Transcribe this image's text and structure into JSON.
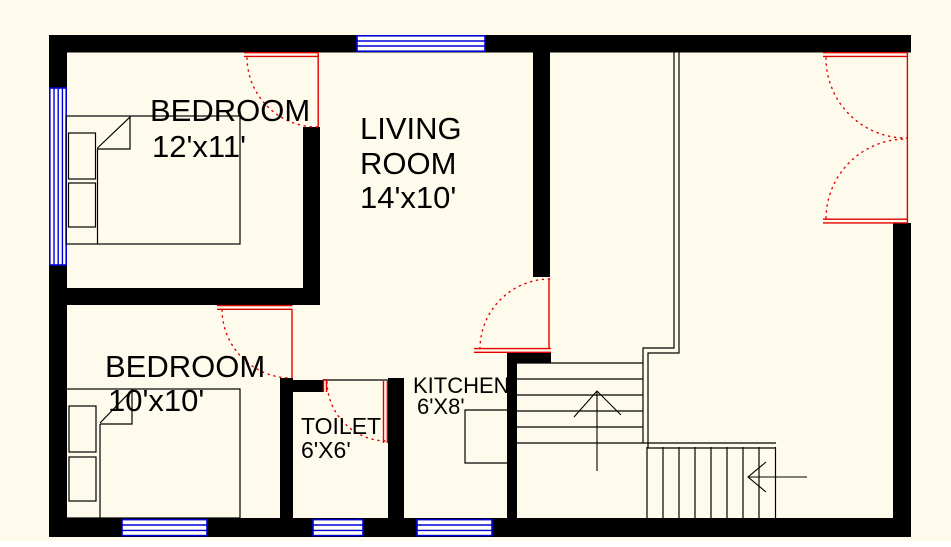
{
  "title": "House Floor Plan",
  "colors": {
    "background": "#fffbec",
    "wall": "#000000",
    "window": "#0000d8",
    "door": "#e00000",
    "text": "#000000"
  },
  "rooms": {
    "bedroom1": {
      "name": "BEDROOM",
      "dims": "12'x11'"
    },
    "living": {
      "line1": "LIVING",
      "line2": "ROOM",
      "dims": "14'x10'"
    },
    "bedroom2": {
      "name": "BEDROOM",
      "dims": "10'x10'"
    },
    "toilet": {
      "name": "TOILET",
      "dims": "6'X6'"
    },
    "kitchen": {
      "name": "KITCHEN",
      "dims": "6'X8'"
    }
  }
}
